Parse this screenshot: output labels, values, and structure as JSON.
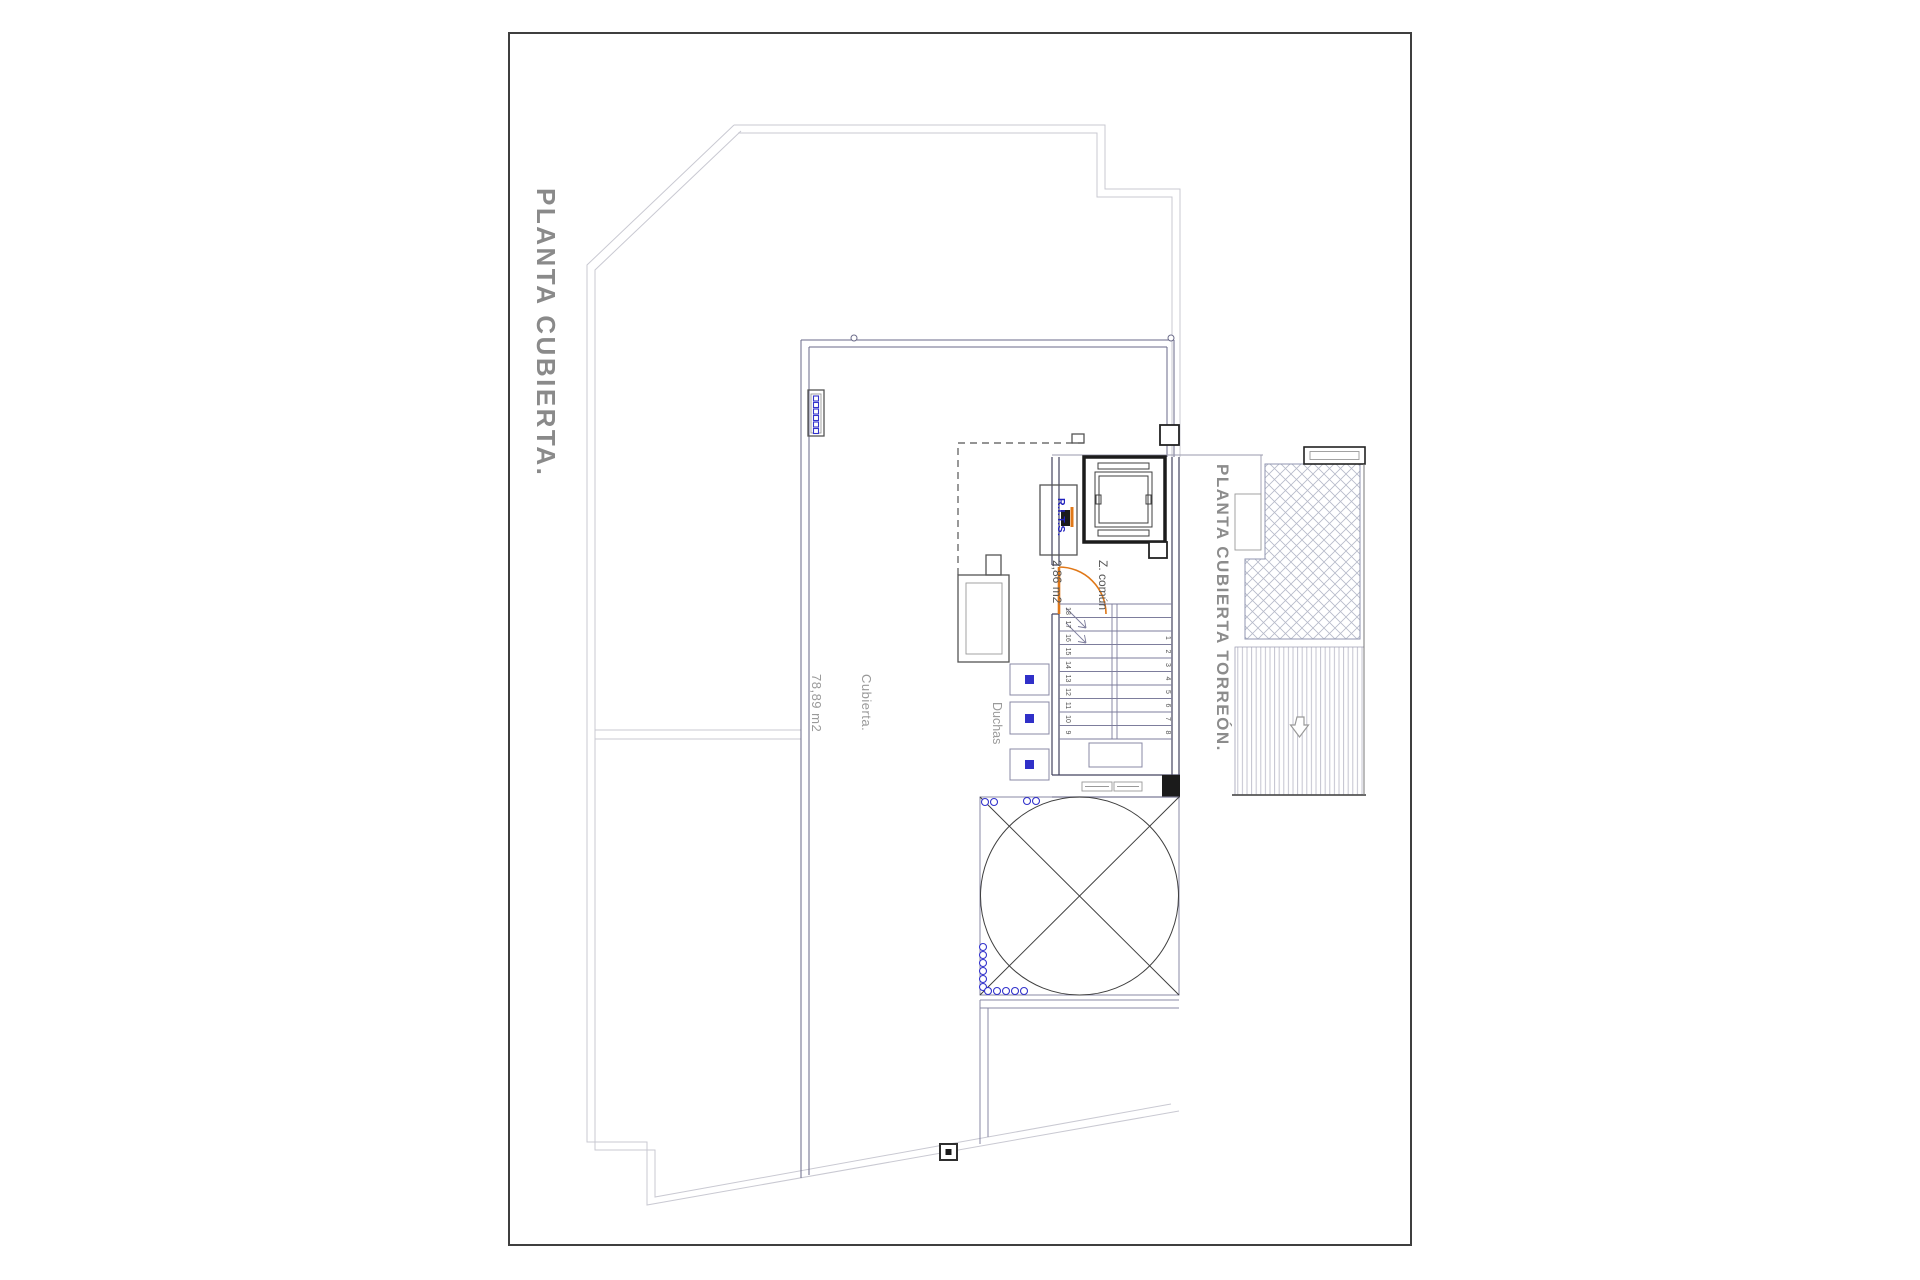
{
  "sheet": {
    "title": "PLANTA CUBIERTA."
  },
  "labels": {
    "roof_area_name": "Cubierta.",
    "roof_area_size": "78,89 m2",
    "showers": "Duchas",
    "common_zone_name": "Z. común",
    "common_zone_size": "2,86 m2",
    "rits": "R.I.T.S.",
    "torreon_title": "PLANTA CUBIERTA TORREÓN."
  },
  "stairs": {
    "left_numbers": [
      "18",
      "17",
      "16",
      "15",
      "14",
      "13",
      "12",
      "11",
      "10",
      "9"
    ],
    "right_numbers": [
      "1",
      "2",
      "3",
      "4",
      "5",
      "6",
      "7",
      "8"
    ]
  },
  "colors": {
    "door_accent": "#e07818",
    "fixture_accent": "#3030c8",
    "label_gray": "#8c8c8c",
    "rits_blue": "#2121bd",
    "outline_light": "#c9c9d2",
    "outline_dark": "#6a6a88"
  },
  "icons": {
    "deck_direction_arrow": "down-arrow"
  }
}
